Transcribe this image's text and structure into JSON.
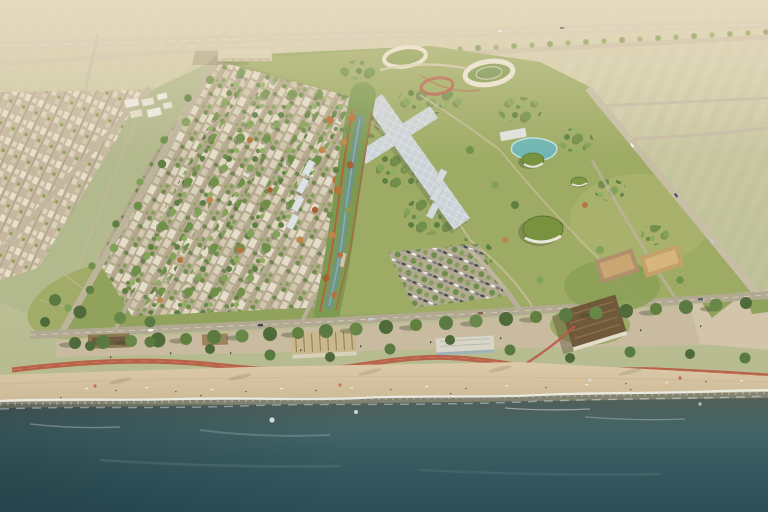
{
  "scene": {
    "title": "Aerial rendering of a coastal masterplan district between open fields and a sandy beach",
    "description": "Bird's-eye architectural visualization: an existing low-rise town and farmland at top left, a new green villa district with a shaded canopy walkway, oval sports rings, a turquoise lagoon and green-roofed pavilions in the middle, and a palm-lined promenade with a winding red cycle path, timber beach clubs, sandy beach and teal sea along the bottom.",
    "lighting": "Warm hazy light, long soft shadows cast toward the shore"
  },
  "palette": {
    "field_far": "#dacfb1",
    "field": "#b7bc90",
    "field_light": "#c6c59e",
    "haze": "#f0e2c6",
    "highway": "#d2c8b0",
    "road": "#c8bea6",
    "road_minor": "#c9bfa7",
    "avenue": "#bdb49c",
    "town_base": "#c6b89e",
    "dev_green": "#90a25b",
    "lawn": "#9dab64",
    "tree": "#6f9048",
    "tree_dark": "#4e6a38",
    "tree_autumn": "#b5743c",
    "canal_park": "#7d9a52",
    "canal_water": "#6f948b",
    "lagoon": "#6db5b3",
    "canopy": "#ccd3d8",
    "roof_white": "#dde2e2",
    "ring": "#ece6d6",
    "track": "#b66450",
    "path_red": "#b65a43",
    "parking": "#b3aa93",
    "coast_road": "#b2a992",
    "promenade": "#c9bba0",
    "plaza": "#d2c5ab",
    "sand": "#dcca a9",
    "sand_top": "#dccaa9",
    "sand_deep": "#ccb995",
    "wet_sand": "#7b7b6c",
    "surf_dark": "#565e56",
    "ocean_near": "#515f59",
    "ocean_mid": "#436467",
    "ocean_deep": "#2c4f58",
    "foam": "#edf0ea",
    "pav_brown": "#8d7854",
    "club_tan": "#b0906a",
    "club_tan2": "#c4a06a",
    "club_dark": "#70583a",
    "cafe_white": "#d8d5c9",
    "green_roof": "#78923f",
    "hall": "#dbcfb2"
  },
  "regions": {
    "fields": "Open farmland and hazy fields",
    "highway": "Coastal highway with tree line",
    "town": "Existing low-rise town blocks",
    "nursery": "Greenhouses and sheds",
    "avenue": "Tree-lined entry avenue",
    "villas": "Terraced villa neighbourhood with green rows",
    "canal": "Landscaped canal corridor with autumn trees",
    "park": "Central community park",
    "canopy": "Shaded white canopy walkway",
    "sports": "Oval sports rings and red running track",
    "lagoon": "Turquoise swimming lagoon",
    "pavilions": "Green-roofed park pavilions",
    "parking": "Tree-shaded parking grove",
    "hall": "Colonnaded community hall",
    "coast_road": "Beachfront road",
    "promenade": "Palm-lined beach promenade",
    "cycle_path": "Winding red cycle path",
    "beach_clubs": "Timber beach clubhouses",
    "beach": "Sandy public beach with loungers",
    "surf": "Breaking surf and foam",
    "ocean": "Open teal sea"
  }
}
